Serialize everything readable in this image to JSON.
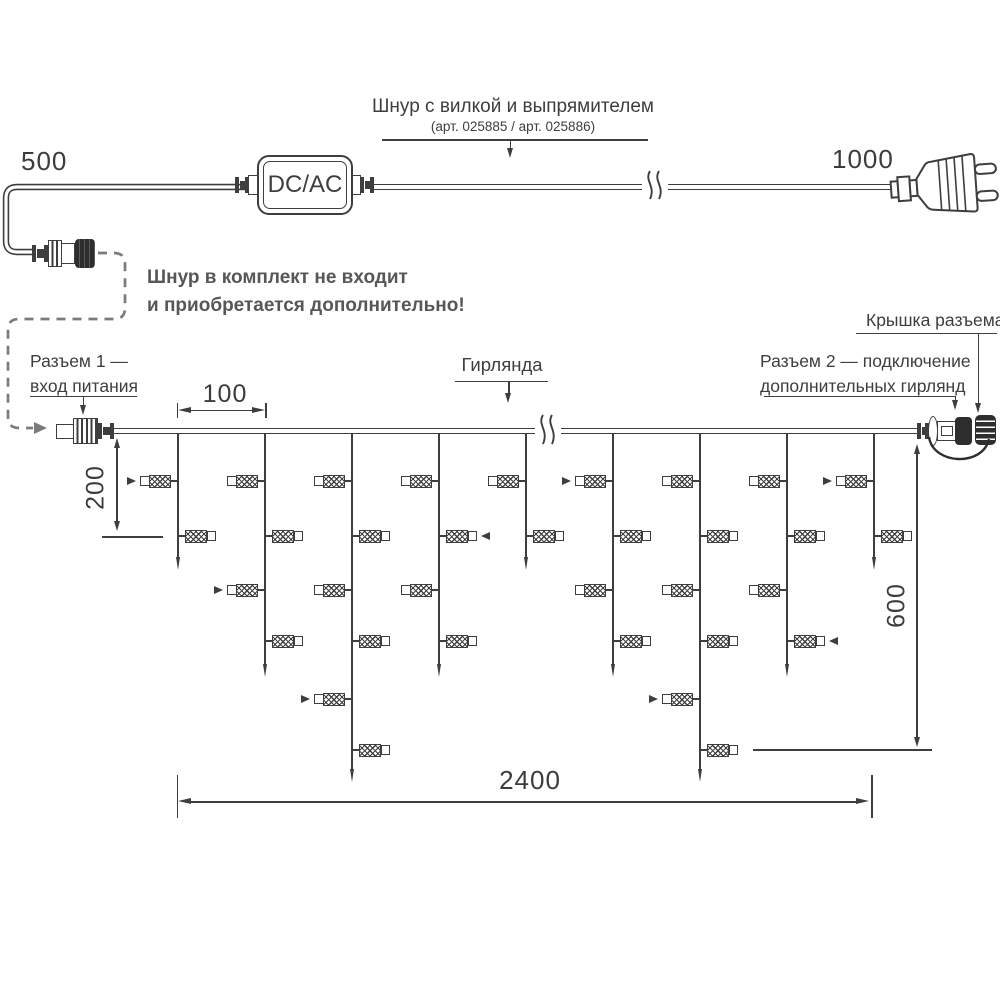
{
  "colors": {
    "ink": "#3e3e3e",
    "gray": "#7b7b7b",
    "note_gray": "#575757"
  },
  "cord": {
    "title": "Шнур с вилкой и выпрямителем",
    "subtitle": "(арт. 025885 / арт. 025886)",
    "adapter_label": "DC/AC",
    "dim_left": "500",
    "dim_right": "1000"
  },
  "note": {
    "line1": "Шнур в комплект не входит",
    "line2": "и приобретается дополнительно!"
  },
  "garland": {
    "connector1_line1": "Разъем 1 —",
    "connector1_line2": "вход питания",
    "garland_label": "Гирлянда",
    "connector2_line1": "Разъем 2 — подключение",
    "connector2_line2": "дополнительных гирлянд",
    "cap_label": "Крышка разъема",
    "drops": [
      {
        "size": "short",
        "lights": [
          {
            "level": 1,
            "side": "left",
            "arrow": true
          },
          {
            "level": 2,
            "side": "right",
            "arrow": false
          }
        ]
      },
      {
        "size": "medium",
        "lights": [
          {
            "level": 1,
            "side": "left",
            "arrow": false
          },
          {
            "level": 2,
            "side": "right",
            "arrow": false
          },
          {
            "level": 3,
            "side": "left",
            "arrow": true
          },
          {
            "level": 4,
            "side": "right",
            "arrow": false
          }
        ]
      },
      {
        "size": "long",
        "lights": [
          {
            "level": 1,
            "side": "left",
            "arrow": false
          },
          {
            "level": 2,
            "side": "right",
            "arrow": false
          },
          {
            "level": 3,
            "side": "left",
            "arrow": false
          },
          {
            "level": 4,
            "side": "right",
            "arrow": false
          },
          {
            "level": 5,
            "side": "left",
            "arrow": true
          },
          {
            "level": 6,
            "side": "right",
            "arrow": false
          }
        ]
      },
      {
        "size": "medium",
        "lights": [
          {
            "level": 1,
            "side": "left",
            "arrow": false
          },
          {
            "level": 2,
            "side": "right",
            "arrow": true
          },
          {
            "level": 3,
            "side": "left",
            "arrow": false
          },
          {
            "level": 4,
            "side": "right",
            "arrow": false
          }
        ]
      },
      {
        "size": "short",
        "lights": [
          {
            "level": 1,
            "side": "left",
            "arrow": false
          },
          {
            "level": 2,
            "side": "right",
            "arrow": false
          }
        ]
      },
      {
        "size": "medium",
        "lights": [
          {
            "level": 1,
            "side": "left",
            "arrow": true
          },
          {
            "level": 2,
            "side": "right",
            "arrow": false
          },
          {
            "level": 3,
            "side": "left",
            "arrow": false
          },
          {
            "level": 4,
            "side": "right",
            "arrow": false
          }
        ]
      },
      {
        "size": "long",
        "lights": [
          {
            "level": 1,
            "side": "left",
            "arrow": false
          },
          {
            "level": 2,
            "side": "right",
            "arrow": false
          },
          {
            "level": 3,
            "side": "left",
            "arrow": false
          },
          {
            "level": 4,
            "side": "right",
            "arrow": false
          },
          {
            "level": 5,
            "side": "left",
            "arrow": true
          },
          {
            "level": 6,
            "side": "right",
            "arrow": false
          }
        ]
      },
      {
        "size": "medium",
        "lights": [
          {
            "level": 1,
            "side": "left",
            "arrow": false
          },
          {
            "level": 2,
            "side": "right",
            "arrow": false
          },
          {
            "level": 3,
            "side": "left",
            "arrow": false
          },
          {
            "level": 4,
            "side": "right",
            "arrow": true
          }
        ]
      },
      {
        "size": "short",
        "lights": [
          {
            "level": 1,
            "side": "left",
            "arrow": true
          },
          {
            "level": 2,
            "side": "right",
            "arrow": false
          }
        ]
      }
    ]
  },
  "dims": {
    "spacing": "100",
    "first_drop": "200",
    "height": "600",
    "length": "2400"
  }
}
